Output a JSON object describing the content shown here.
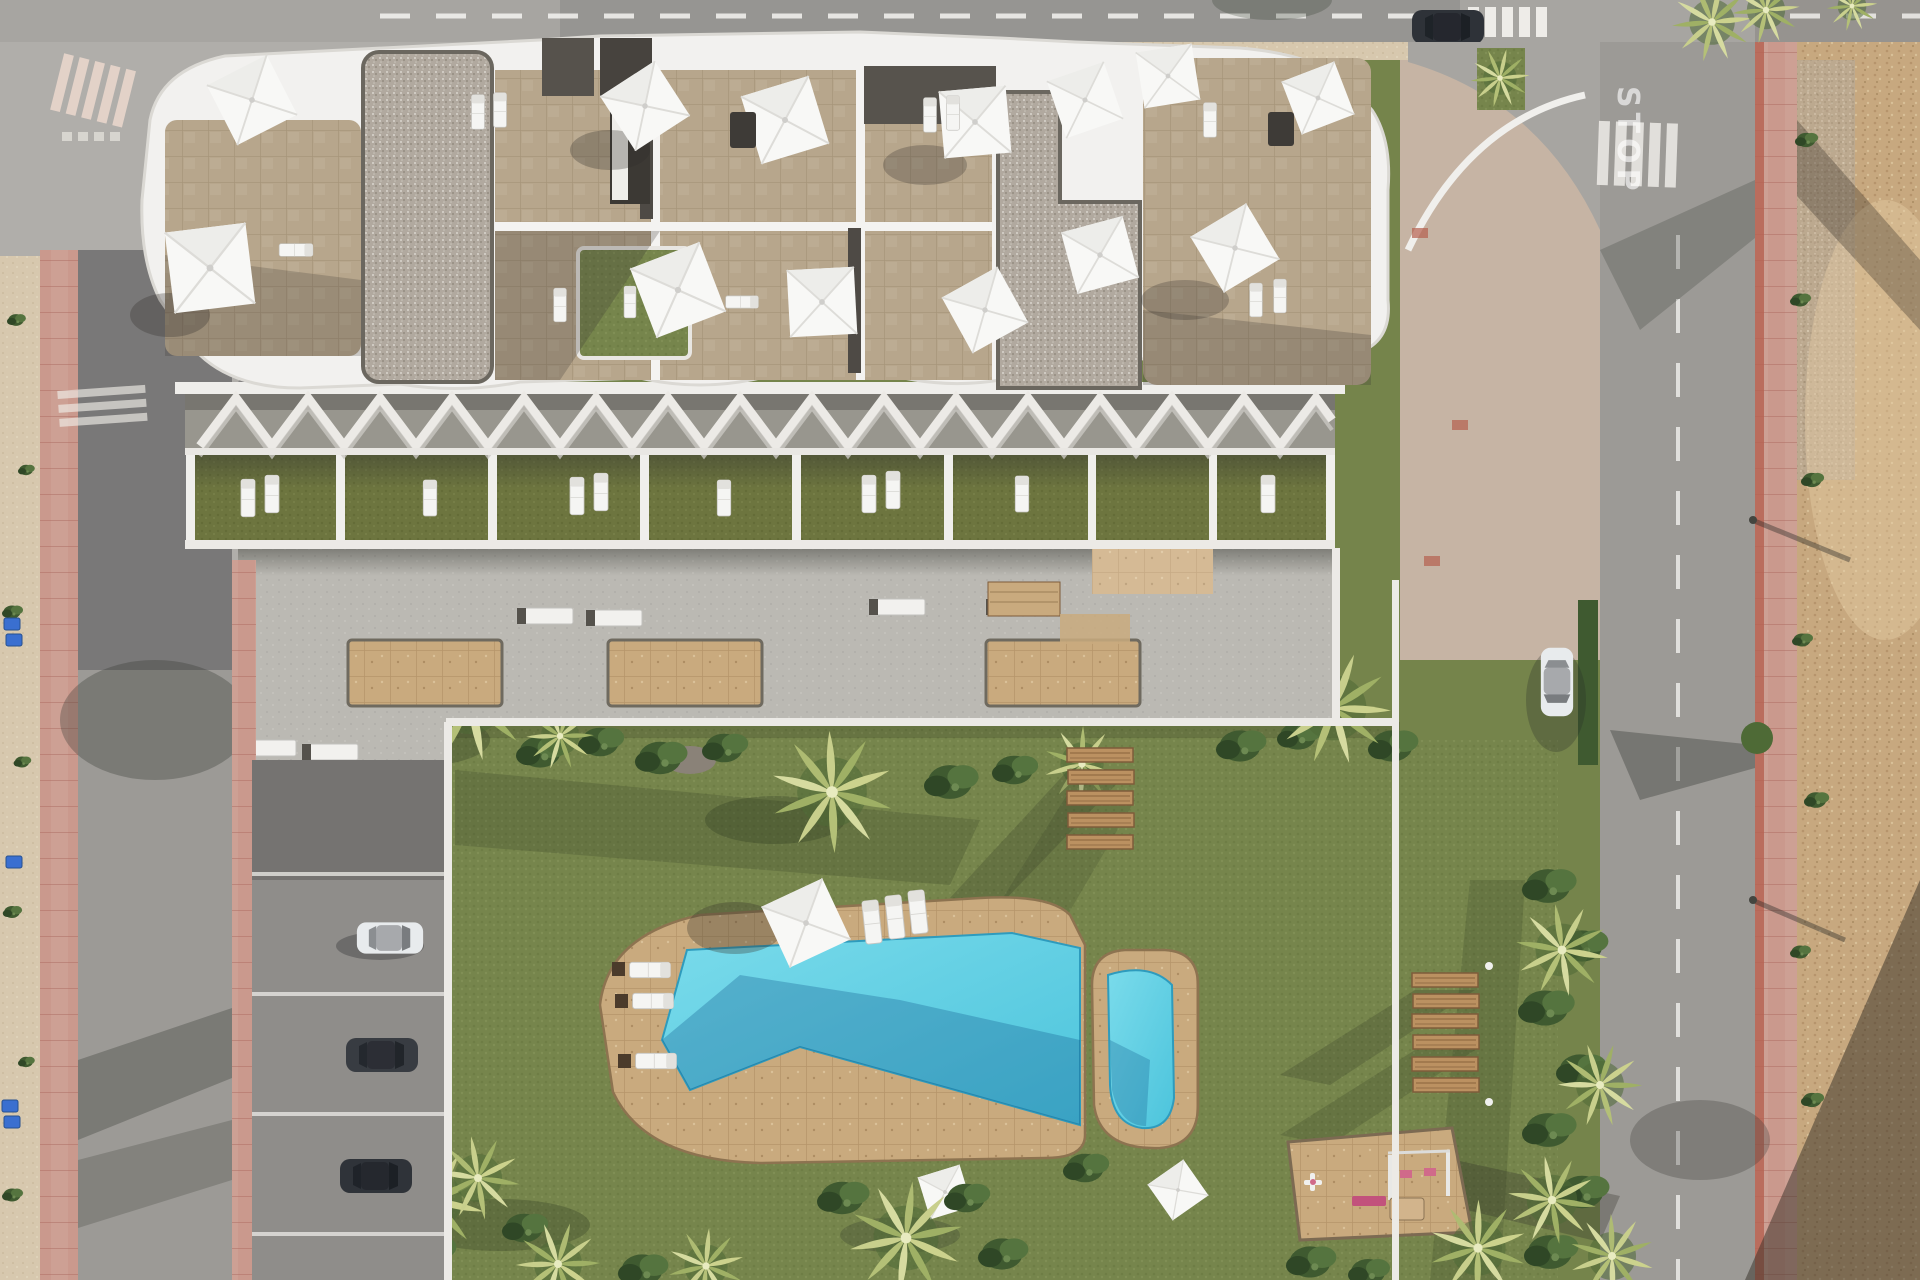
{
  "scene": {
    "title": "Aerial top-down architectural render of a residential complex with roof terraces, communal garden, pools and surrounding streets",
    "markings": {
      "stop": "STOP"
    },
    "palette": {
      "asphalt": "#9c9a96",
      "asphalt_light": "#b0aeaa",
      "sidewalk_pink": "#cda094",
      "dirt_strip_sand": "#d7c8ae",
      "dirt_lot": "#c7a87f",
      "lawn_green": "#76854c",
      "terrace_lawn": "#6d753f",
      "plaza_concrete": "#bbb9b3",
      "planter_sand": "#c9a672",
      "roof_tile_beige": "#b7a68c",
      "roof_gravel": "#b1a99f",
      "parapet_white": "#f2f1ef",
      "dark_roof": "#56524c",
      "pool_water": "#5bcfe4",
      "pool_water_shadow": "#2f9cc0",
      "pool_deck": "#c9aa7e",
      "wood_plank": "#bb9161",
      "white_furniture": "#f6f6f4",
      "car_dark": "#33373d",
      "car_white": "#e8ebed",
      "recycle_bin_blue": "#3a6fd0",
      "playground_pink": "#cd6f92"
    },
    "inventory": {
      "roof_sun_sails": 13,
      "pool_sun_sails": 3,
      "terrace_units": 7,
      "plaza_planters": 3,
      "plaza_benches": 6,
      "stepping_planks": 5,
      "lawn_wood_benches": 6,
      "swimming_pools": 2,
      "inner_parked_cars": 3,
      "street_cars": 2,
      "recycle_bins": 5,
      "playground_items": 4
    }
  }
}
